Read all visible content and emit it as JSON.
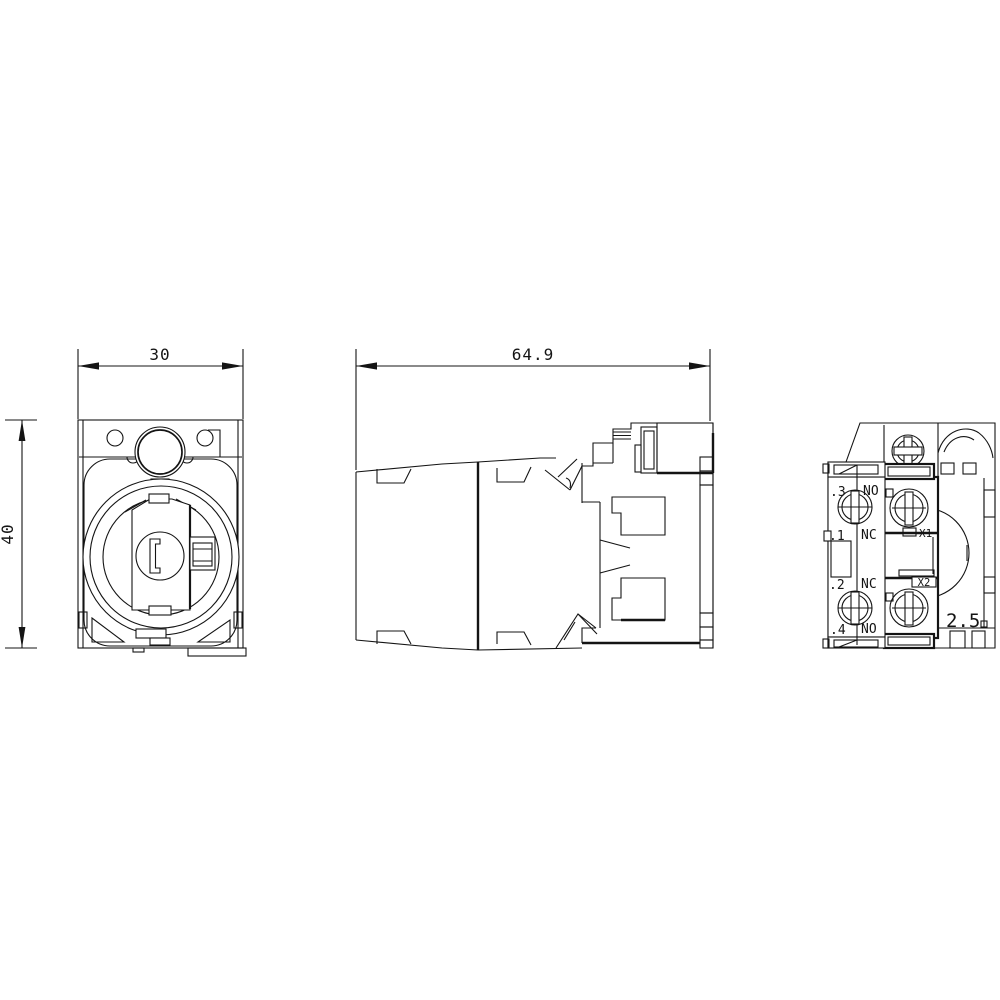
{
  "colors": {
    "background": "#ffffff",
    "line": "#141414"
  },
  "front_view": {
    "dim_width": "30",
    "dim_height": "40"
  },
  "side_view": {
    "dim_depth": "64.9"
  },
  "rear_view": {
    "terminals": [
      {
        "id": ".3",
        "type": "NO"
      },
      {
        "id": ".1",
        "type": "NC"
      },
      {
        "id": ".2",
        "type": "NC"
      },
      {
        "id": ".4",
        "type": "NO"
      }
    ],
    "lamp_terminals": [
      "X1",
      "X2"
    ],
    "conductor_cross_section": "2.5"
  }
}
